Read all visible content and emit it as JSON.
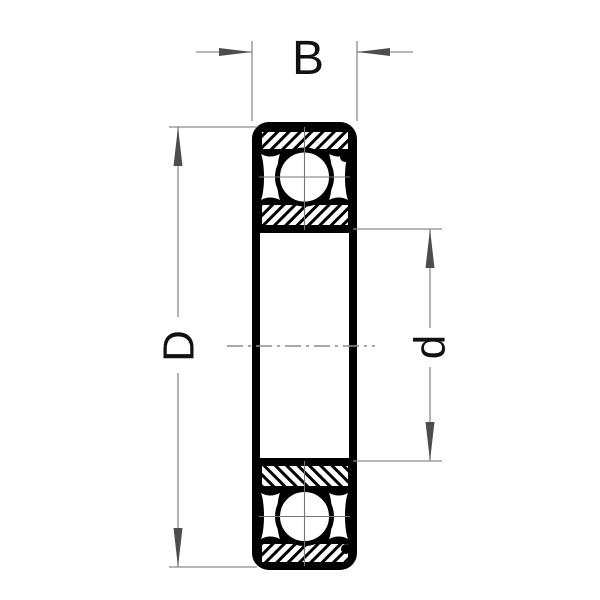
{
  "diagram": {
    "kind": "ball-bearing-cross-section",
    "labels": {
      "width": "B",
      "outer_diameter": "D",
      "bore_diameter": "d"
    },
    "colors": {
      "outline": "#000000",
      "hatch": "#000000",
      "dimension_line": "#8c8c8c",
      "centerline": "#8c8c8c",
      "arrow": "#4d4d4d",
      "background": "#ffffff",
      "text": "#111111"
    }
  }
}
